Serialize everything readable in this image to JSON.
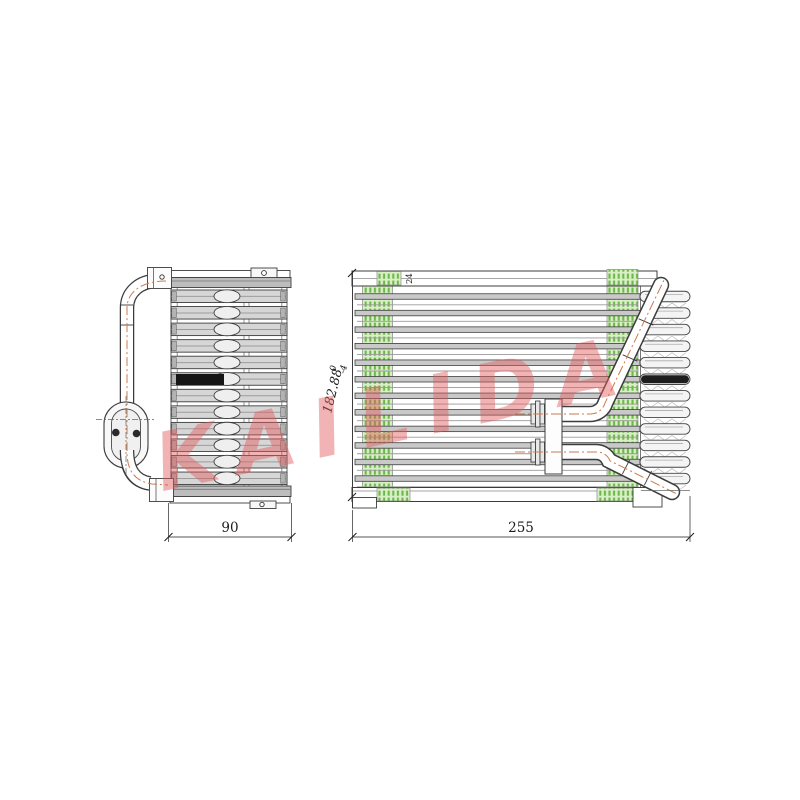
{
  "page": {
    "background": "#ffffff",
    "description": "technical line drawing of automotive A/C evaporator core, side view and front view"
  },
  "watermark": {
    "text": "KAILIDA",
    "color": "#e05a5a"
  },
  "labels": {
    "side_view_width": "90",
    "front_view_width": "255",
    "front_view_height": "182.88",
    "front_view_height_tol_upper": "0",
    "front_view_height_tol_lower": "-4",
    "depth_note": "24"
  },
  "colors": {
    "line": "#3c3c3c",
    "metal_gray": "#c9c9c9",
    "header_gray": "#bdbdbd",
    "fin_green": "#6cb84c",
    "green_background": "#d9efc5",
    "pipe_centerline_orange": "#cc7a4d",
    "black_tube": "#161616",
    "dimension_line": "#555555"
  }
}
